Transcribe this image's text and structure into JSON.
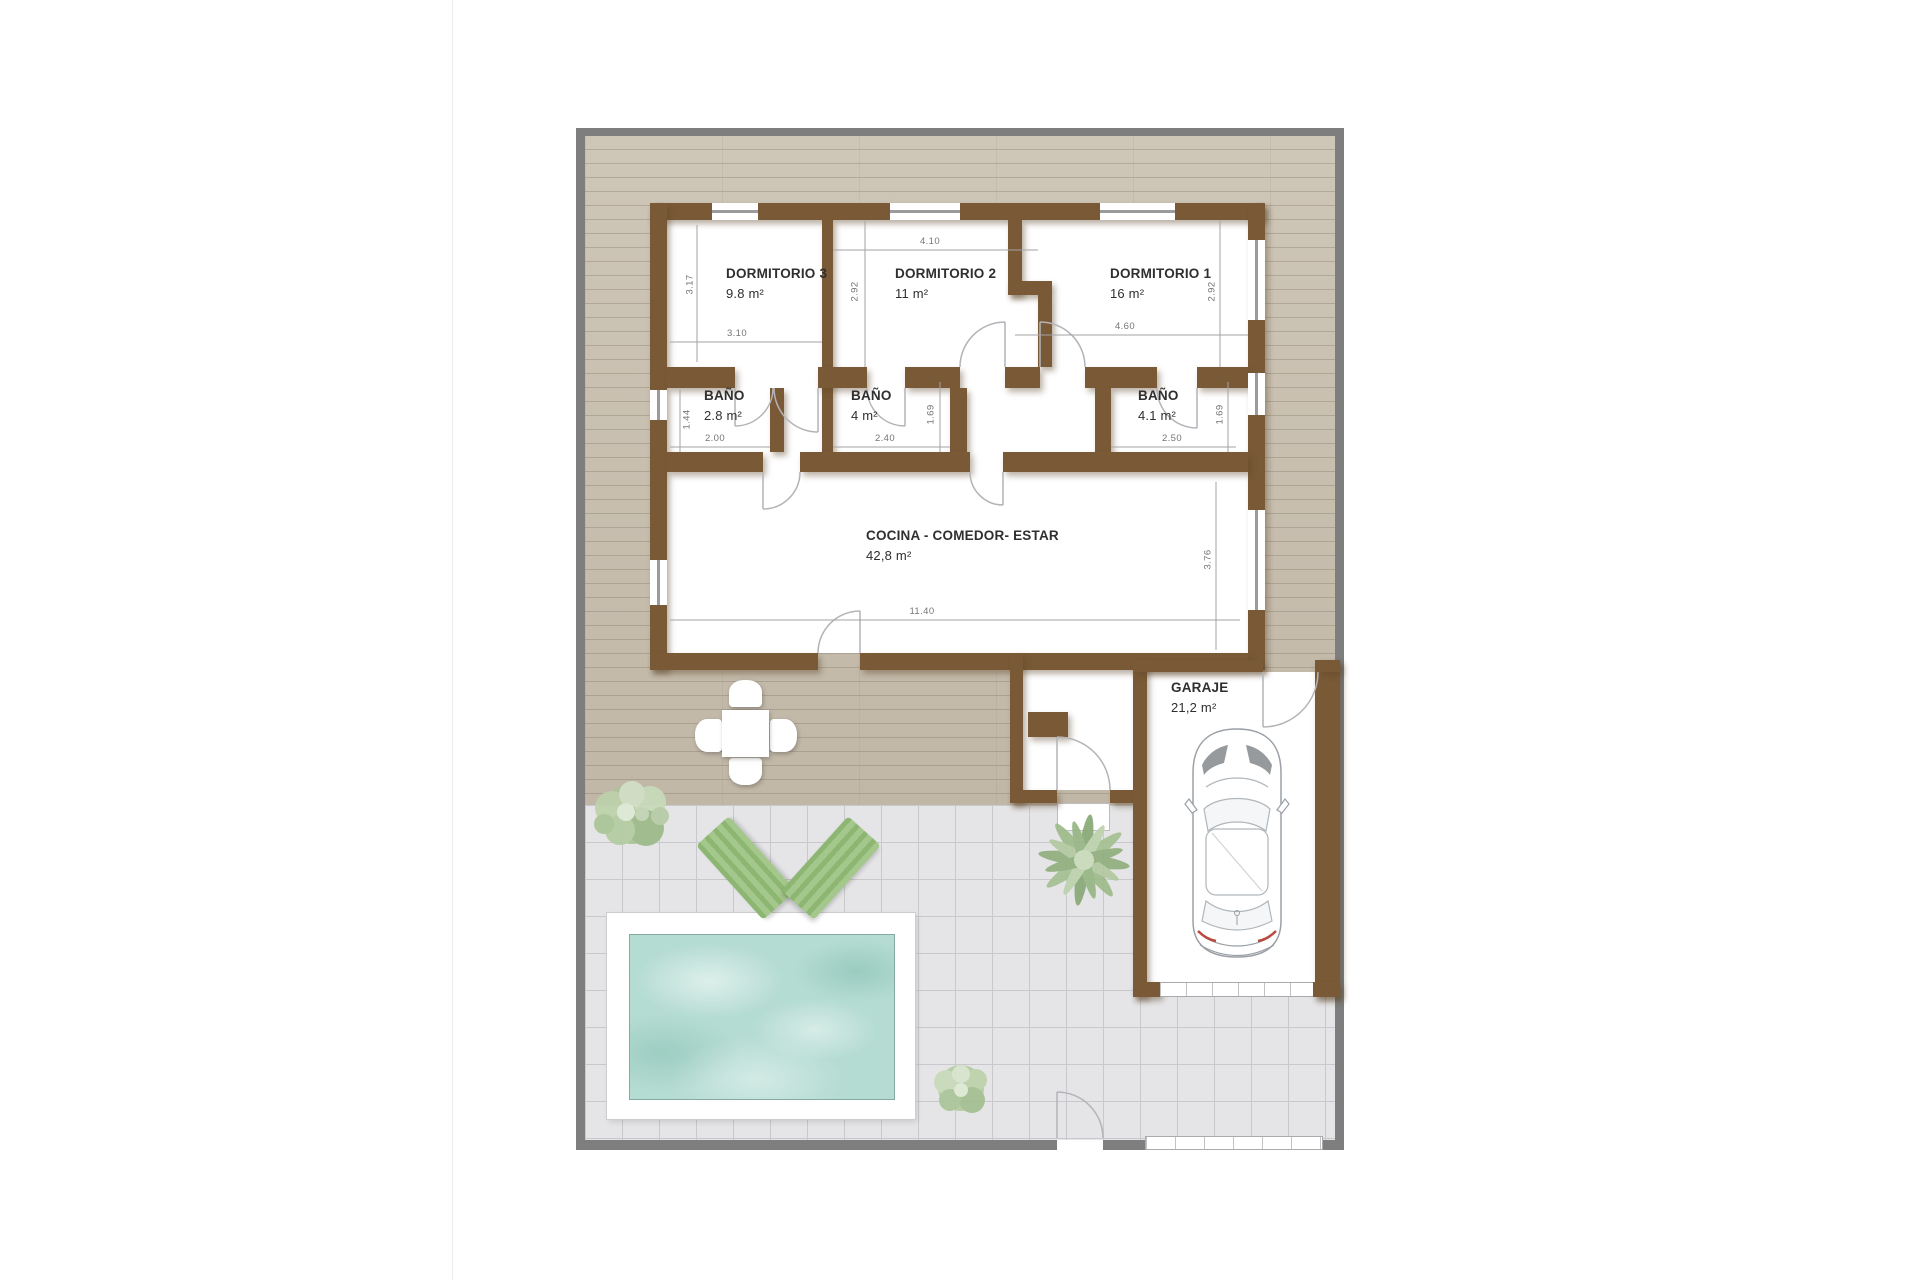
{
  "plan": {
    "title": "Planta de vivienda unifamiliar con piscina y garaje",
    "rooms": {
      "dorm3": {
        "name": "DORMITORIO 3",
        "area": "9.8 m²"
      },
      "dorm2": {
        "name": "DORMITORIO 2",
        "area": "11 m²"
      },
      "dorm1": {
        "name": "DORMITORIO 1",
        "area": "16 m²"
      },
      "bath1": {
        "name": "BAÑO",
        "area": "2.8 m²"
      },
      "bath2": {
        "name": "BAÑO",
        "area": "4 m²"
      },
      "bath3": {
        "name": "BAÑO",
        "area": "4.1 m²"
      },
      "living": {
        "name": "COCINA - COMEDOR- ESTAR",
        "area": "42,8 m²"
      },
      "garage": {
        "name": "GARAJE",
        "area": "21,2 m²"
      }
    },
    "dims": {
      "dorm3_w": "3.10",
      "dorm3_h": "3.17",
      "dorm2_w": "4.10",
      "dorm2_h": "2.92",
      "dorm1_w": "4.60",
      "dorm1_h": "2.92",
      "bath1_w": "2.00",
      "bath1_h": "1.44",
      "bath2_w": "2.40",
      "bath2_h": "1.69",
      "bath3_w": "2.50",
      "bath3_h": "1.69",
      "living_w": "11.40",
      "living_h": "3.76"
    },
    "colors": {
      "wall": "#7a5a36",
      "deck": "#c8bfb0",
      "tile": "#e5e5e7",
      "water": "#b5dcd3",
      "frame": "#7e7e7e",
      "lounger": "#a4c78b"
    }
  }
}
